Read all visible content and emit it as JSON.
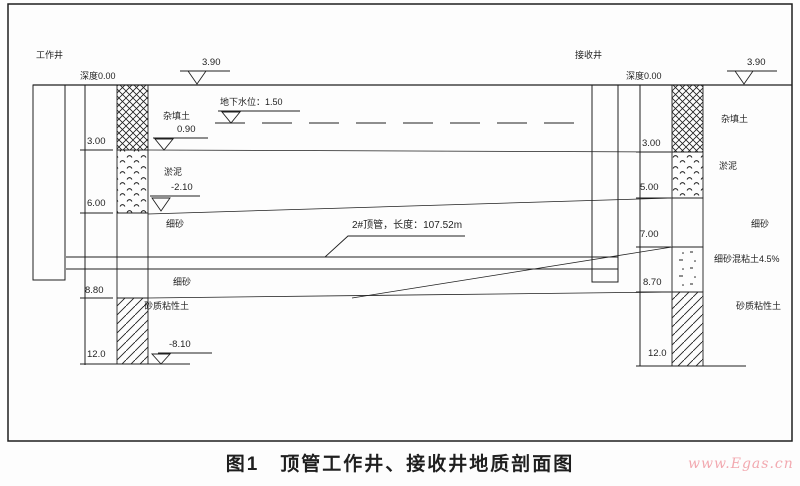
{
  "caption": "图1　顶管工作井、接收井地质剖面图",
  "watermark": "www.Egas.cn",
  "colors": {
    "ink": "#1f1f1f",
    "watermark": "#f2a9b0",
    "paper": "#fdfdfd"
  },
  "left_shaft": {
    "title": "工作井",
    "datum": "深度0.00",
    "surface_elevation": "3.90",
    "depths": [
      "3.00",
      "6.00",
      "8.80",
      "12.0"
    ],
    "strata": {
      "fill": "杂填土",
      "fill_elev": "0.90",
      "silt": "淤泥",
      "silt_elev": "-2.10",
      "sand_upper": "细砂",
      "sand_lower": "细砂",
      "sandy_clay": "砂质粘性土"
    },
    "bottom_elevation": "-8.10"
  },
  "right_shaft": {
    "title": "接收井",
    "datum": "深度0.00",
    "surface_elevation": "3.90",
    "depths": [
      "3.00",
      "5.00",
      "7.00",
      "8.70",
      "12.0"
    ],
    "strata": {
      "fill": "杂填土",
      "silt": "淤泥",
      "sand": "细砂",
      "sand_clay_mix": "细砂混粘土4.5%",
      "sandy_clay": "砂质粘性土"
    }
  },
  "annotations": {
    "groundwater": "地下水位：1.50",
    "pipe": "2#顶管，长度：107.52m"
  }
}
